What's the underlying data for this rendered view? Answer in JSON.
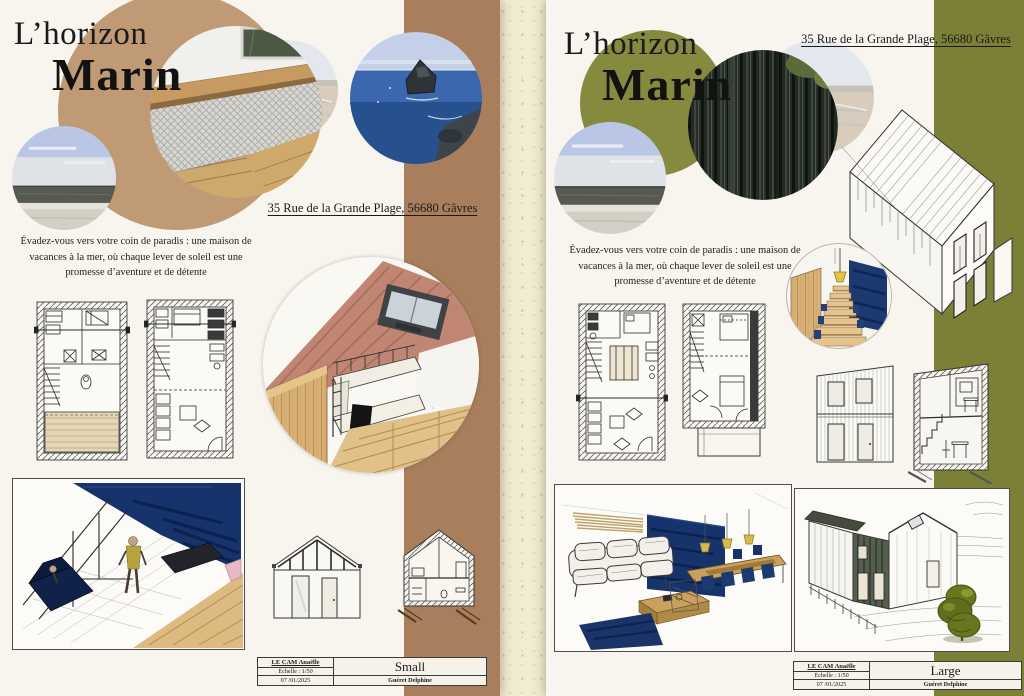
{
  "scene": {
    "description": "Two architectural presentation posters pinned side by side on a speckled cream board",
    "background_color": "#f1ecd2"
  },
  "posters": {
    "left": {
      "title_line1": "L’horizon",
      "title_line2": "Marin",
      "address": "35 Rue de la Grande Plage, 56680 Gâvres",
      "intro": "Évadez-vous vers votre coin de paradis : une maison de vacances à la mer, où chaque lever de soleil est une promesse d’aventure et de détente",
      "accent_stripe_color": "#a87e5c",
      "title_circle_color": "#c09a74",
      "title_block": {
        "author": "LE CAM Anaëlle",
        "scale": "Échelle : 1/50",
        "date": "07 /01/2025",
        "variant": "Small",
        "drafter": "Guéret Delphine"
      }
    },
    "right": {
      "title_line1": "L’horizon",
      "title_line2": "Marin",
      "address": "35 Rue de la Grande Plage, 56680 Gâvres",
      "intro": "Évadez-vous vers votre coin de paradis : une maison de vacances à la mer, où chaque lever de soleil est une promesse d’aventure et de détente",
      "accent_stripe_color": "#7c8036",
      "title_circle_color": "#868a3e",
      "title_block": {
        "author": "LE CAM Anaëlle",
        "scale": "Échelle : 1/50",
        "date": "07 /01/2025",
        "variant": "Large",
        "drafter": "Guéret Delphine"
      }
    }
  }
}
